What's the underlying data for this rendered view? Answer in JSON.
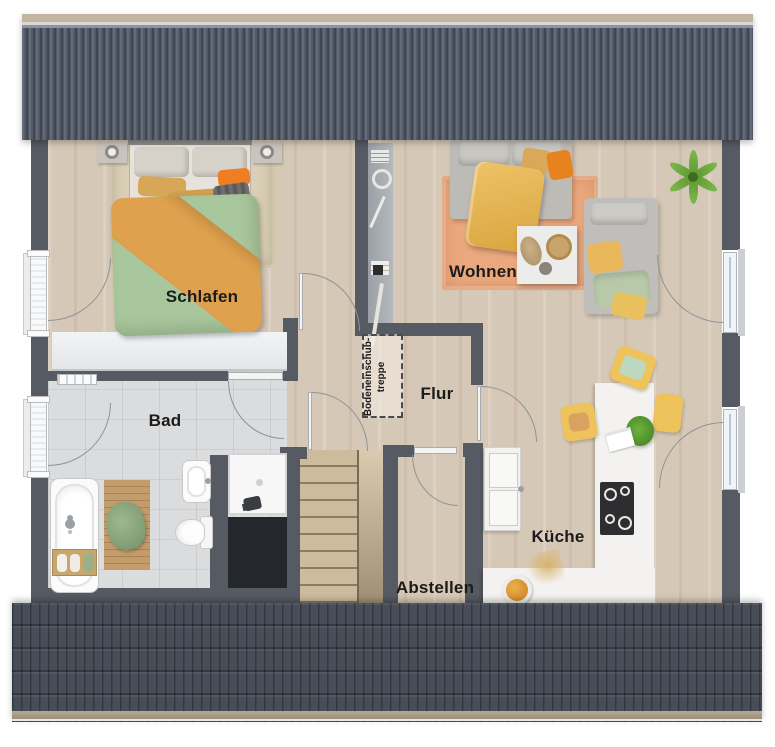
{
  "rooms": {
    "schlafen": {
      "label": "Schlafen"
    },
    "wohnen": {
      "label": "Wohnen"
    },
    "bad": {
      "label": "Bad"
    },
    "flur": {
      "label": "Flur"
    },
    "kueche": {
      "label": "Küche"
    },
    "abstellen": {
      "label": "Abstellen"
    }
  },
  "annotations": {
    "attic_stairs_line1": "Bodeneinschub-",
    "attic_stairs_line2": "treppe"
  },
  "colors": {
    "roof": "#525a68",
    "wall": "#565a62",
    "wood_floor": "#d6c8b6",
    "tile_floor": "#dadcde",
    "rug_living": "#eba87e",
    "rug_bedroom": "#d9d0b6",
    "duvet_green": "#a9c79c",
    "blanket_orange": "#e0a14e",
    "chair_yellow": "#eec35c",
    "counter_white": "#f3f2f0",
    "void": "#24272b"
  }
}
